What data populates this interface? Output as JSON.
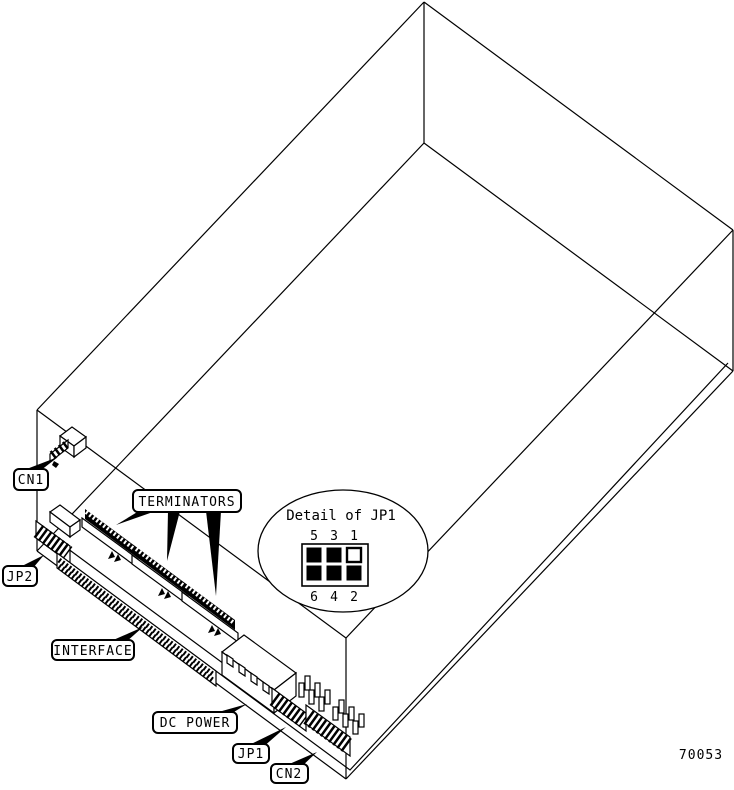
{
  "figure": {
    "figure_number": "70053",
    "colors": {
      "line": "#000000",
      "background": "#ffffff"
    },
    "callouts": {
      "cn1": "CN1",
      "jp2": "JP2",
      "terminators": "TERMINATORS",
      "interface": "INTERFACE",
      "dc_power": "DC POWER",
      "jp1": "JP1",
      "cn2": "CN2"
    },
    "jp1_detail": {
      "title": "Detail of JP1",
      "top_pin_labels": [
        "5",
        "3",
        "1"
      ],
      "bottom_pin_labels": [
        "6",
        "4",
        "2"
      ],
      "jumper_grid": [
        [
          1,
          1,
          0
        ],
        [
          1,
          1,
          1
        ]
      ]
    }
  }
}
